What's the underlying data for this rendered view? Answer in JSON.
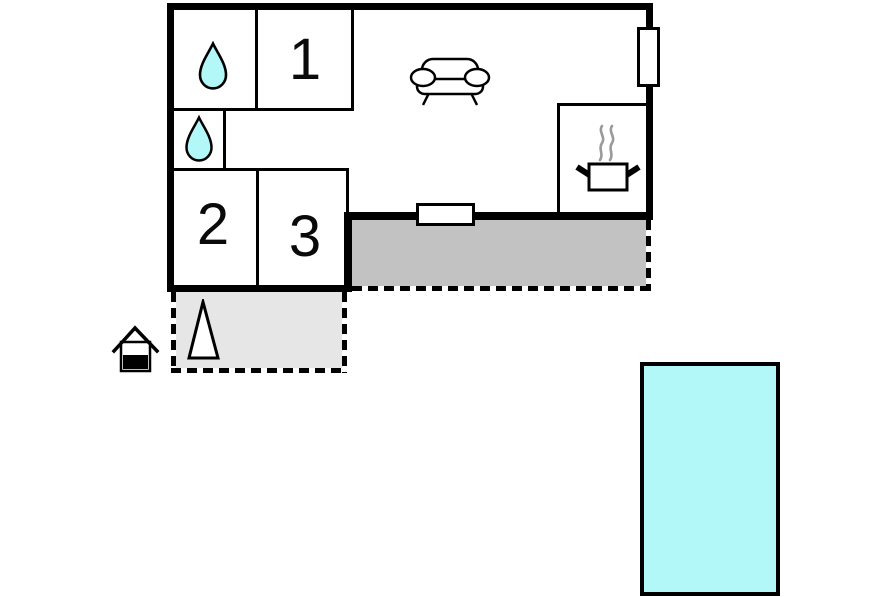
{
  "floorplan": {
    "rooms": [
      {
        "label": "1"
      },
      {
        "label": "2"
      },
      {
        "label": "3"
      }
    ],
    "icons": [
      "water-drop-icon",
      "water-drop-icon",
      "sofa-icon",
      "cooking-pot-icon",
      "shed-icon",
      "tree-icon"
    ],
    "colors": {
      "wall": "#000000",
      "water": "#b3f8f9",
      "terrace": "#c2c2c2",
      "patio": "#e6e6e6",
      "steam": "#9a9a9a",
      "background": "#ffffff"
    }
  }
}
